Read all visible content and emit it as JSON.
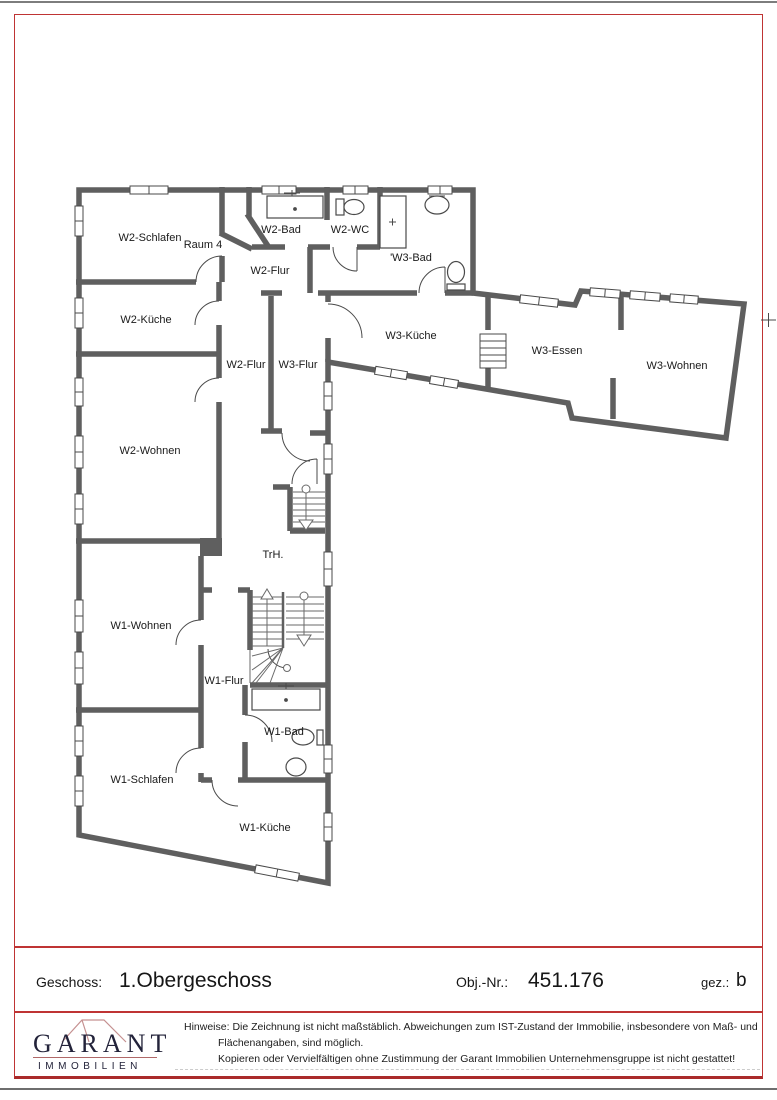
{
  "plan": {
    "rooms": [
      {
        "label": "W2-Schlafen"
      },
      {
        "label": "Raum 4"
      },
      {
        "label": "W2-Bad"
      },
      {
        "label": "W2-WC"
      },
      {
        "label": "'W3-Bad"
      },
      {
        "label": "W2-Flur"
      },
      {
        "label": "W2-Küche"
      },
      {
        "label": "W3-Küche"
      },
      {
        "label": "W2-Flur"
      },
      {
        "label": "W3-Flur"
      },
      {
        "label": "W3-Essen"
      },
      {
        "label": "W3-Wohnen"
      },
      {
        "label": "W2-Wohnen"
      },
      {
        "label": "TrH."
      },
      {
        "label": "W1-Wohnen"
      },
      {
        "label": "W1-Flur"
      },
      {
        "label": "W1-Bad"
      },
      {
        "label": "W1-Schlafen"
      },
      {
        "label": "W1-Küche"
      }
    ]
  },
  "title_block": {
    "geschoss_label": "Geschoss:",
    "geschoss_value": "1.Obergeschoss",
    "objnr_label": "Obj.-Nr.:",
    "objnr_value": "451.176",
    "gez_label": "gez.:",
    "gez_value": "b"
  },
  "footer": {
    "logo_name": "GARANT",
    "logo_subtitle": "IMMOBILIEN",
    "hinweise_label": "Hinweise:",
    "hinweise_line1": "Die Zeichnung ist nicht maßstäblich. Abweichungen zum IST-Zustand der Immobilie, insbesondere von Maß- und",
    "hinweise_line2": "Flächenangaben, sind möglich.",
    "hinweise_line3": "Kopieren oder Vervielfältigen ohne Zustimmung der Garant Immobilien Unternehmensgruppe ist nicht gestattet!"
  },
  "colors": {
    "frame_red": "#bf3434",
    "wall_gray": "#5f5f5f",
    "detail_gray": "#4a4a4a",
    "logo_navy": "#23233a",
    "logo_roof_pink": "#c59090",
    "logo_underline_red": "#b06868"
  }
}
